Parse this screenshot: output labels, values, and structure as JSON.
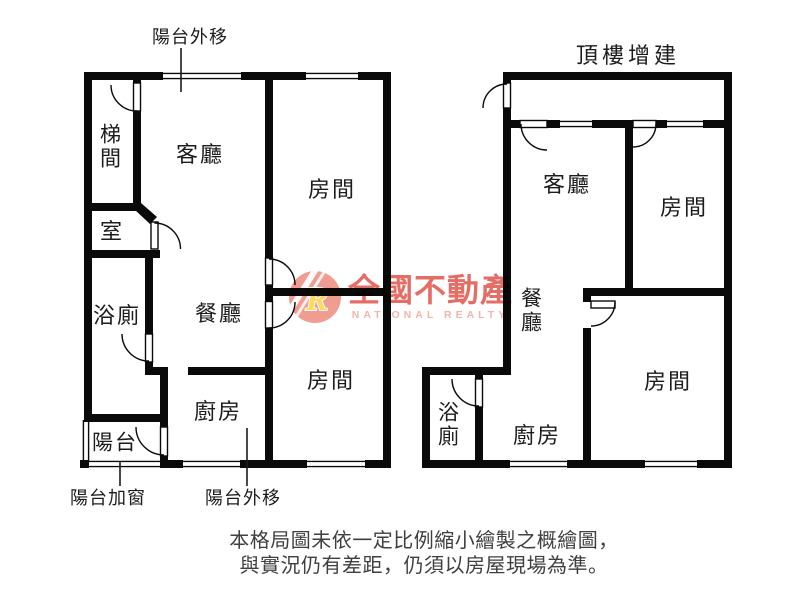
{
  "left_plan": {
    "note_top": "陽台外移",
    "stairwell": "梯間",
    "living": "客廳",
    "room_top": "房間",
    "inner_room": "室",
    "bath": "浴廁",
    "dining": "餐廳",
    "room_bottom": "房間",
    "kitchen": "廚房",
    "balcony": "陽台",
    "note_bottom_left": "陽台加窗",
    "note_bottom_center": "陽台外移"
  },
  "right_plan": {
    "title": "頂樓增建",
    "living": "客廳",
    "room_top": "房間",
    "dining": "餐廳",
    "bath": "浴廁",
    "kitchen": "廚房",
    "room_bottom": "房間"
  },
  "watermark": {
    "logo_letter": "R",
    "brand": "全國不動產",
    "brand_en": "NATIONAL REALTY"
  },
  "disclaimer": {
    "line1": "本格局圖未依一定比例縮小繪製之概繪圖，",
    "line2": "與實況仍有差距，仍須以房屋現場為準。"
  },
  "colors": {
    "wall": "#0a0a0a",
    "ink": "#1c1c1c",
    "muted": "#3f3f3f",
    "brand": "#e0544a",
    "brandEn": "#f0a89f",
    "logo": "#ef8b7d",
    "gold": "#ffd23e"
  }
}
